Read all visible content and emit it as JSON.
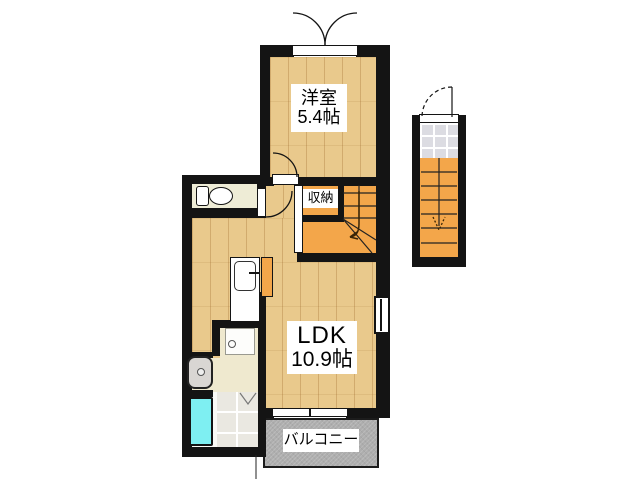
{
  "rooms": {
    "western_room": {
      "name": "洋室",
      "size": "5.4帖"
    },
    "ldk": {
      "name": "LDK",
      "size": "10.9帖"
    },
    "closet": {
      "name": "収納"
    },
    "balcony": {
      "name": "バルコニー"
    }
  },
  "colors": {
    "wall": "#141414",
    "wood_floor": "#E9C98C",
    "stair_orange": "#F3A64A",
    "toilet_floor": "#EEECD6",
    "washroom_floor": "#EFE9CF",
    "bath_tile": "#EAE8E1",
    "entry_tile": "#DCDCE2",
    "bathtub": "#7EEFF2",
    "balcony_gray": "#AEAEAE"
  },
  "icons": {
    "toilet": "toilet-fixture-icon",
    "kitchen_sink": "kitchen-sink-icon",
    "washing_machine_pan": "washer-pan-icon",
    "vanity": "vanity-basin-icon",
    "bathtub": "bathtub-icon",
    "interior_stair_arrow": "stair-down-arrow-icon",
    "exterior_stair_arrow": "stair-down-arrow-icon",
    "folding_bath_door": "folding-door-icon"
  }
}
